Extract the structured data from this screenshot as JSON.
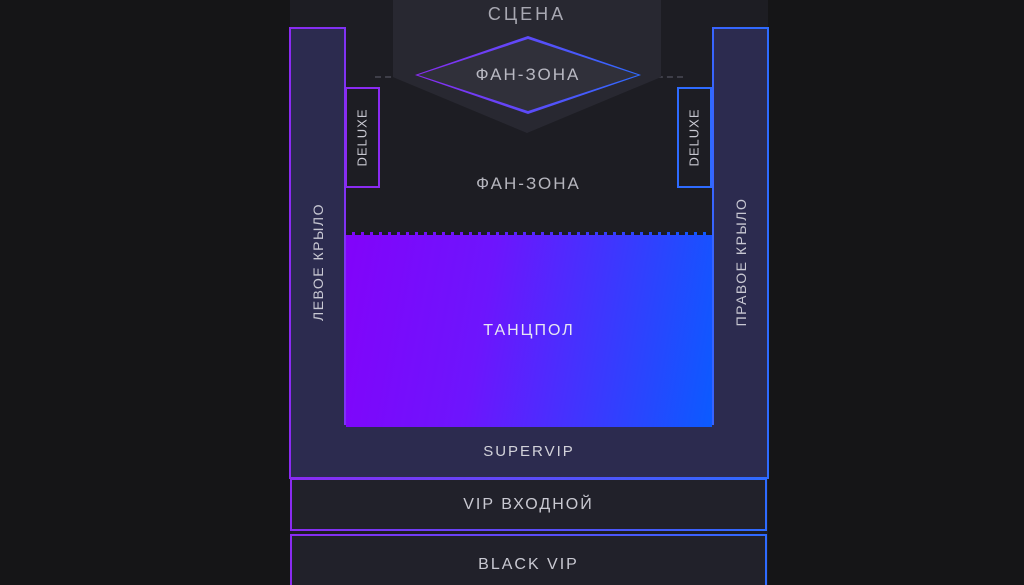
{
  "colors": {
    "accent_purple": "#8a2bf2",
    "accent_blue": "#2e6bff",
    "dancefloor_gradient_start": "#8203fa",
    "dancefloor_gradient_end": "#0b5bff",
    "wing_fill": "#2c2b4f",
    "hall_background": "#1d1d23",
    "stage_fill": "#282831",
    "box_fill": "#21212a",
    "page_background": "#151517"
  },
  "map": {
    "stage": {
      "label": "СЦЕНА"
    },
    "fan_zone_diamond": {
      "label": "ФАН-ЗОНА"
    },
    "fan_zone_area": {
      "label": "ФАН-ЗОНА"
    },
    "deluxe_left": {
      "label": "DELUXE"
    },
    "deluxe_right": {
      "label": "DELUXE"
    },
    "left_wing": {
      "label": "ЛЕВОЕ КРЫЛО"
    },
    "right_wing": {
      "label": "ПРАВОЕ КРЫЛО"
    },
    "dancefloor": {
      "label": "ТАНЦПОЛ"
    },
    "supervip": {
      "label": "SUPERVIP"
    },
    "vip_entrance": {
      "label": "VIP ВХОДНОЙ"
    },
    "black_vip": {
      "label": "BLACK VIP"
    }
  }
}
